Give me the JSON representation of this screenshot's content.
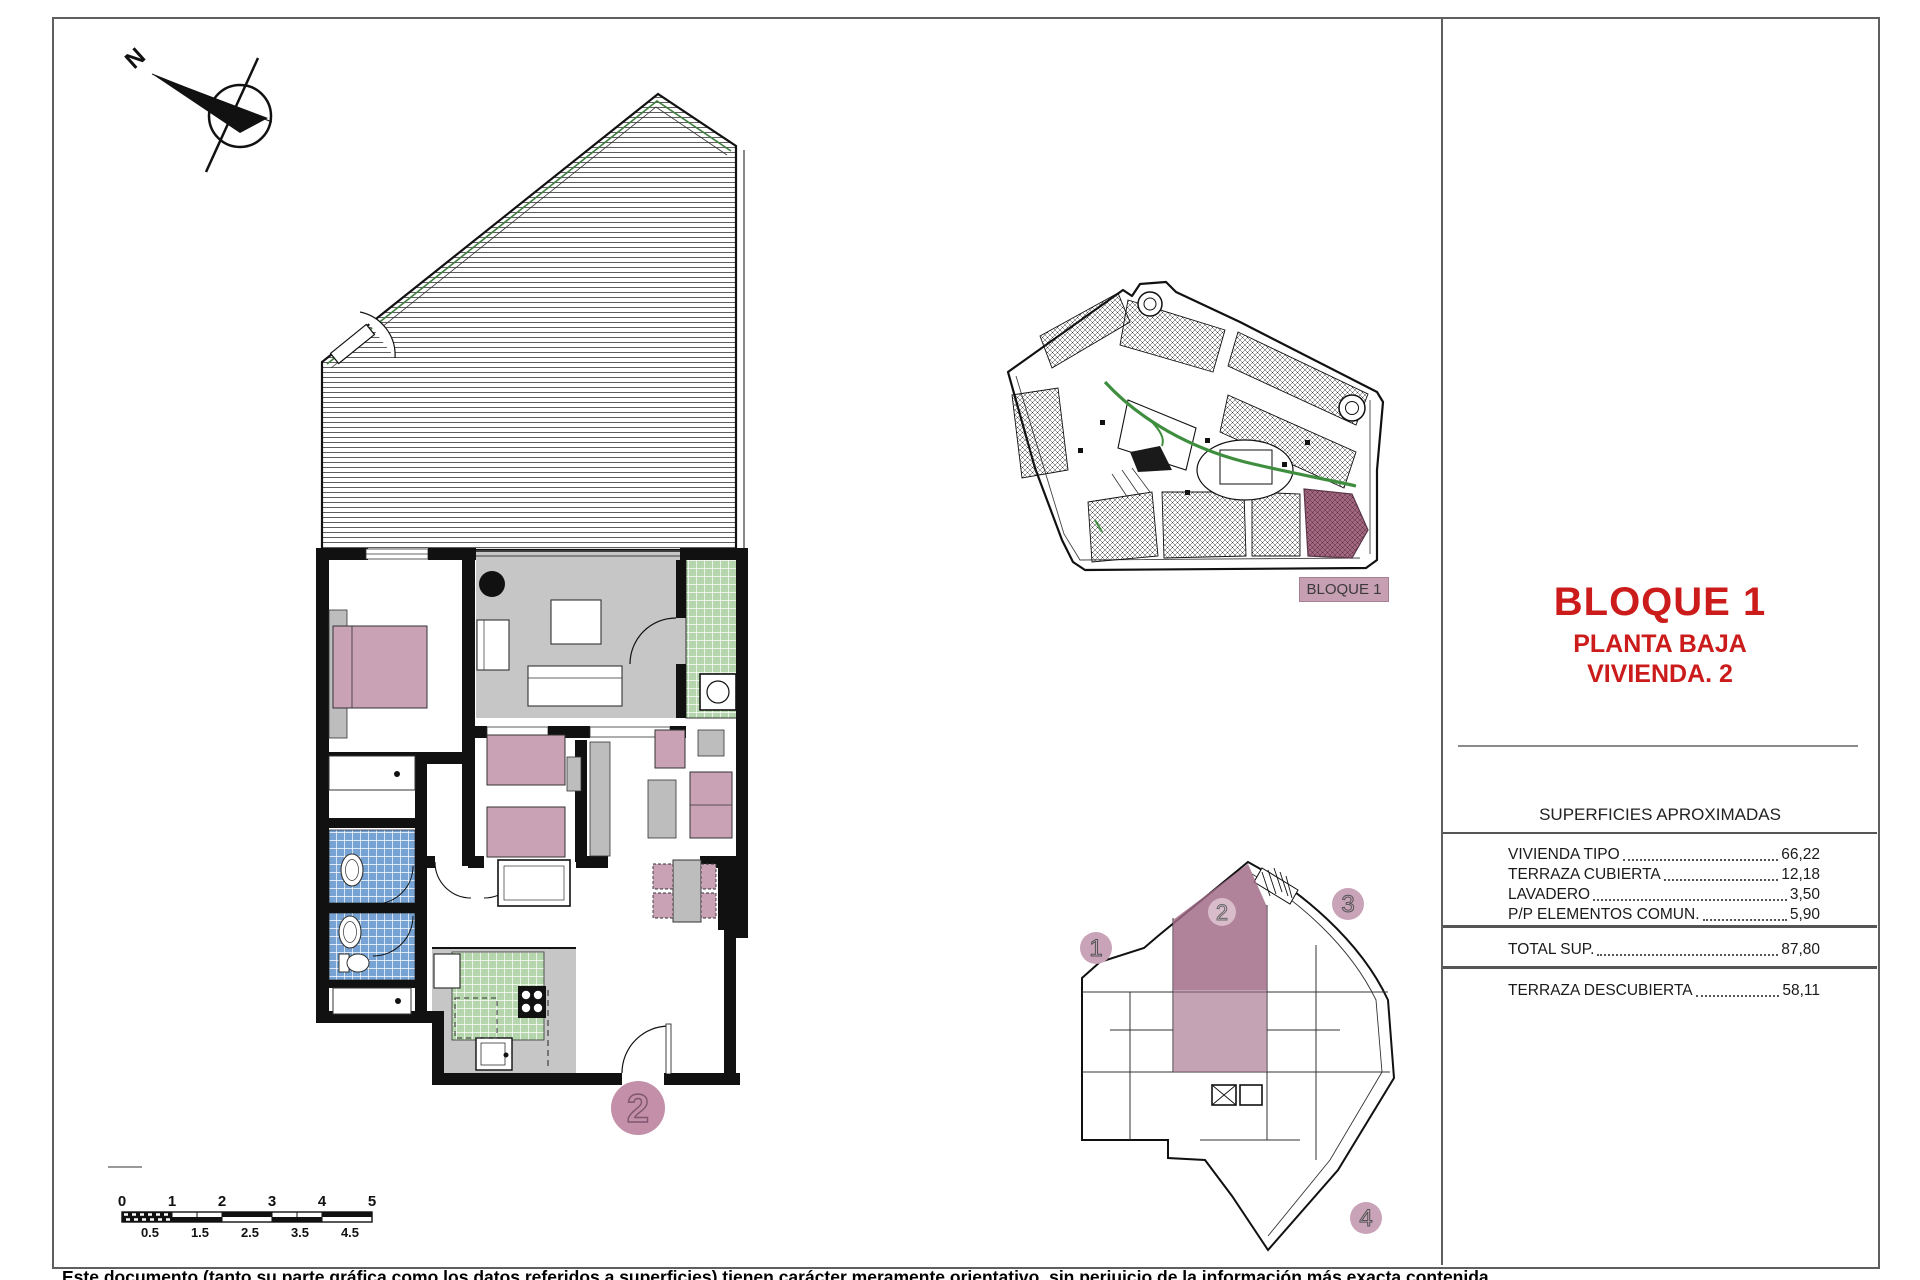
{
  "title_block": {
    "main": "BLOQUE 1",
    "sub1": "PLANTA BAJA",
    "sub2": "VIVIENDA. 2"
  },
  "site_plan": {
    "block_label": "BLOQUE 1"
  },
  "areas": {
    "header": "SUPERFICIES APROXIMADAS",
    "rows": [
      {
        "label": "VIVIENDA TIPO",
        "value": "66,22"
      },
      {
        "label": "TERRAZA CUBIERTA",
        "value": "12,18"
      },
      {
        "label": "LAVADERO",
        "value": "3,50"
      },
      {
        "label": "P/P ELEMENTOS COMUN.",
        "value": "5,90"
      }
    ],
    "total_label": "TOTAL SUP.",
    "total_value": "87,80",
    "terrace_label": "TERRAZA DESCUBIERTA",
    "terrace_value": "58,11"
  },
  "key_plan": {
    "unit1": "1",
    "unit2": "2",
    "unit3": "3",
    "unit4": "4",
    "highlighted_unit": "2"
  },
  "floor_plan": {
    "unit_label": "2",
    "north_label": "N"
  },
  "scale_bar": {
    "top": [
      "0",
      "1",
      "2",
      "3",
      "4",
      "5"
    ],
    "bottom": [
      "0.5",
      "1.5",
      "2.5",
      "3.5",
      "4.5"
    ]
  },
  "footer": {
    "disclaimer": "Este documento (tanto su parte gráfica como los datos referidos a superficies) tienen carácter meramente orientativo, sin perjuicio de la información más exacta contenida"
  },
  "colors": {
    "accent_red": "#cc1b1b",
    "highlight_mauve": "#a06a86",
    "furniture_pink": "#c9a2b6",
    "label_pink": "#c79fb2",
    "unit_circle_pink": "#c48fa9",
    "tile_blue": "#76a3d4",
    "tile_green": "#b5d5ad",
    "floor_gray": "#c6c6c6",
    "road_green": "#3f8e3f"
  }
}
